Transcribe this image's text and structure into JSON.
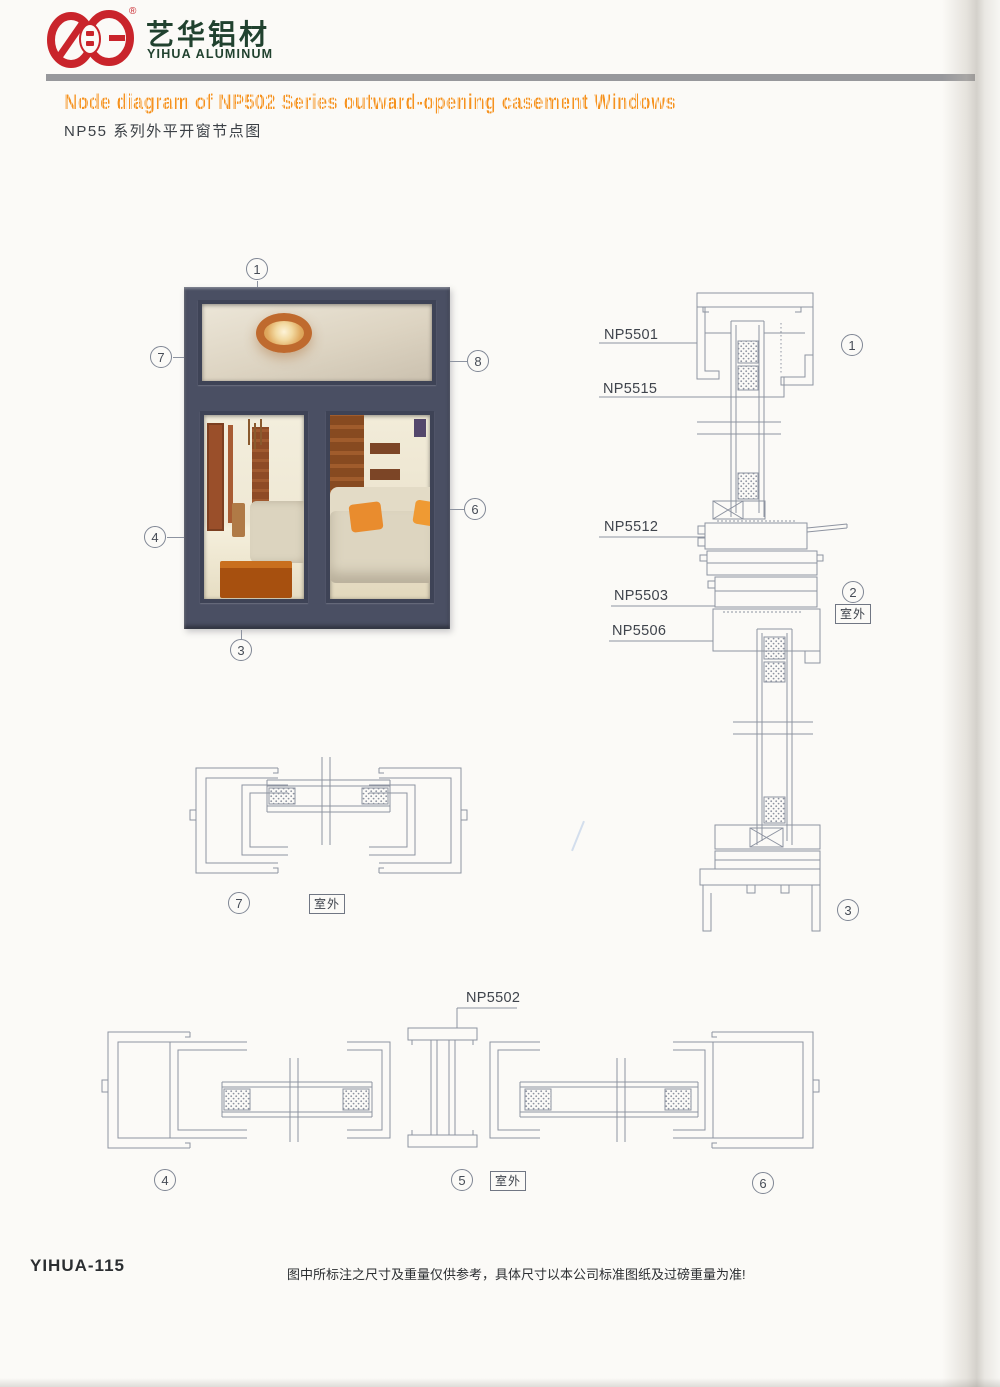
{
  "brand": {
    "name_cn": "艺华铝材",
    "name_en": "YIHUA ALUMINUM",
    "registered_mark": "®"
  },
  "header": {
    "title_en": "Node diagram of NP502 Series outward-opening casement Windows",
    "title_cn": "NP55 系列外平开窗节点图"
  },
  "window_figure": {
    "callout_top": "1",
    "callout_left_upper": "7",
    "callout_right_upper": "8",
    "callout_left_lower": "4",
    "callout_right_lower": "6",
    "callout_bottom": "3"
  },
  "vertical_section": {
    "labels": {
      "np5501": "NP5501",
      "np5515": "NP5515",
      "np5512": "NP5512",
      "np5503": "NP5503",
      "np5506": "NP5506"
    },
    "callout_head": "1",
    "callout_transom": "2",
    "callout_sill": "3",
    "outdoor_label": "室外"
  },
  "plan_section_head": {
    "callout": "7",
    "outdoor_label": "室外"
  },
  "plan_section_bottom": {
    "label_np5502": "NP5502",
    "callout_left": "4",
    "callout_center": "5",
    "callout_right": "6",
    "outdoor_label": "室外"
  },
  "footer": {
    "doc_code": "YIHUA-115",
    "disclaimer": "图中所标注之尺寸及重量仅供参考，具体尺寸以本公司标准图纸及过磅重量为准!"
  }
}
